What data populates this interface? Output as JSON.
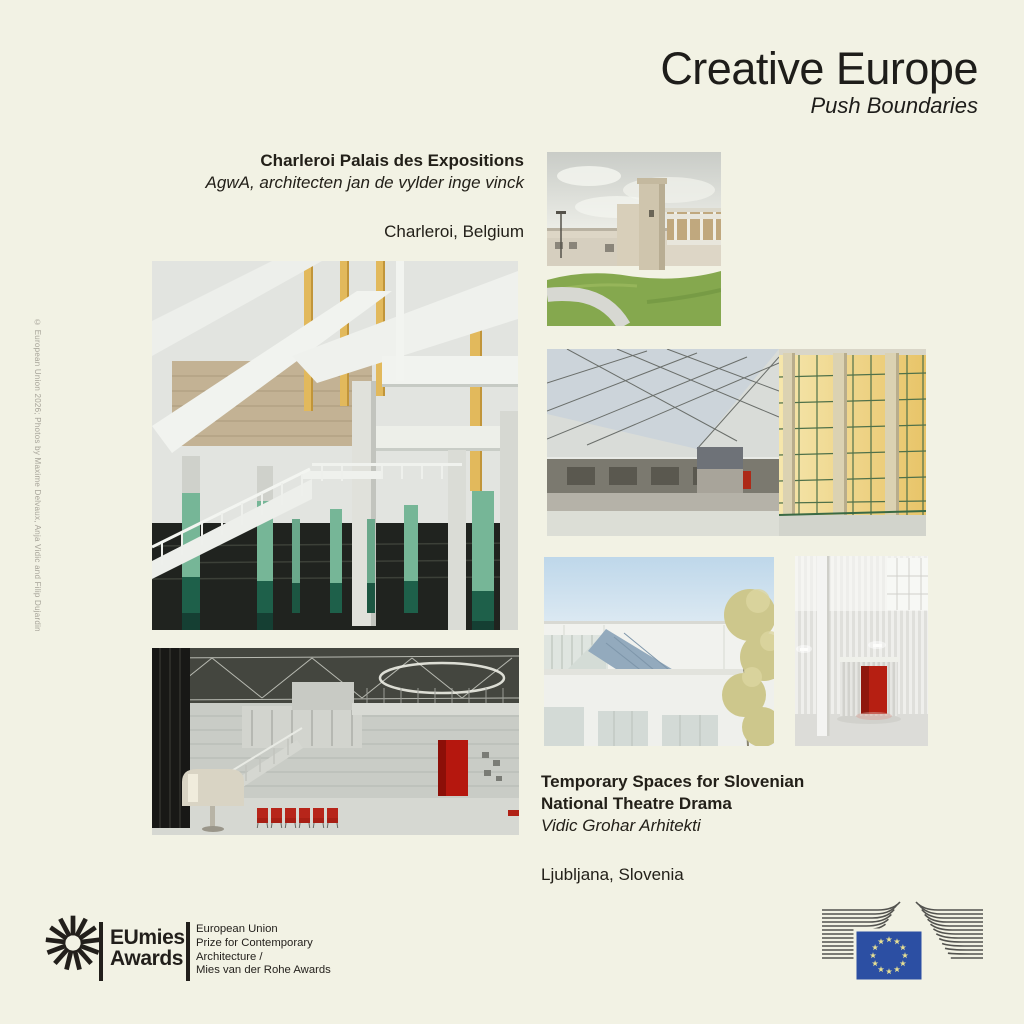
{
  "canvas": {
    "background": "#f2f2e4",
    "text_color": "#22201c"
  },
  "header": {
    "title": "Creative Europe",
    "subtitle": "Push Boundaries"
  },
  "credit": "© European Union 2026; Photos by Maxime Delvaux, Anja Vidic and Filip Dujardin",
  "project_belgium": {
    "name": "Charleroi Palais des Expositions",
    "architect": "AgwA, architecten jan de vylder inge vinck",
    "location": "Charleroi, Belgium"
  },
  "project_slovenia": {
    "name_line1": "Temporary Spaces for Slovenian",
    "name_line2": "National Theatre Drama",
    "architect": "Vidic Grohar Arhitekti",
    "location": "Ljubljana, Slovenia"
  },
  "eumies_logo": {
    "word1": "EUmies",
    "word2": "Awards",
    "tagline": [
      "European Union",
      "Prize for Contemporary",
      "Architecture /",
      "Mies van der Rohe Awards"
    ]
  },
  "ec_logo": {
    "flag_blue": "#2c4fa3",
    "star_yellow": "#e9e193",
    "line_gray": "#53534f"
  },
  "accent_colors": {
    "teal_column": "#6fb292",
    "dark_green": "#1e604a",
    "yellow_post": "#e2b95c",
    "red": "#b31d12"
  },
  "photos": [
    {
      "name": "charleroi-exterior-photo",
      "alt": "Exterior with concrete tower, lawn and curved path"
    },
    {
      "name": "charleroi-interior-columns-photo",
      "alt": "Interior with green columns, yellow posts and white stair"
    },
    {
      "name": "charleroi-glass-hall-photo",
      "alt": "Exhibition hall with glass roof and yellow windows"
    },
    {
      "name": "ljubljana-blue-roof-photo",
      "alt": "White building with slanted blue roof and tree"
    },
    {
      "name": "ljubljana-curtain-room-photo",
      "alt": "Room with silver curtains and red booth"
    },
    {
      "name": "ljubljana-theatre-hall-photo",
      "alt": "Theatre hall with silver walls, red chairs and red doorway"
    }
  ]
}
